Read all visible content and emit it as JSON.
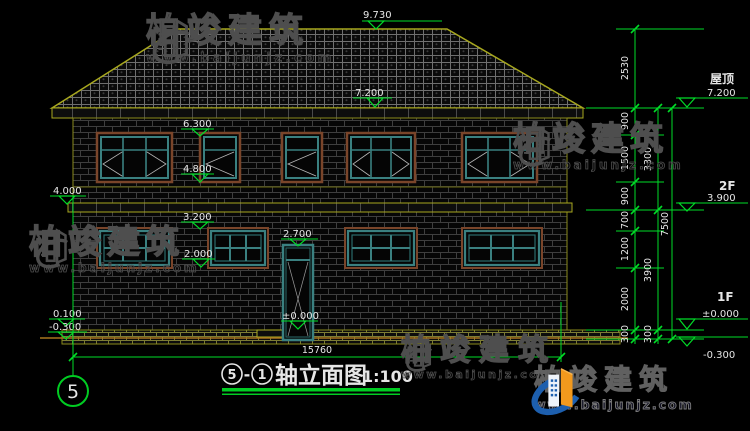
{
  "watermark": {
    "brand": "柏竣建筑",
    "url": "www.baijunjz.com"
  },
  "levels": {
    "ridge": "9.730",
    "eave": "7.200",
    "f2_win_top": "6.300",
    "f2_win_btm": "4.800",
    "belt": "4.000",
    "f1_win_top": "3.200",
    "f1_win_btm": "2.000",
    "door_top": "2.700",
    "door_floor": "±0.000",
    "plinth": "0.100",
    "ground": "-0.300"
  },
  "floors": {
    "roof_name": "屋顶",
    "roof_lvl": "7.200",
    "f2_name": "2F",
    "f2_lvl": "3.900",
    "f1_name": "1F",
    "f1_lvl": "±0.000",
    "ground_lvl": "-0.300"
  },
  "dims": {
    "c1": [
      "2530",
      "900",
      "1500",
      "900",
      "700",
      "1200",
      "2000",
      "300"
    ],
    "c2": [
      "3300",
      "3900",
      "300"
    ],
    "c3": [
      "7500"
    ],
    "total": "15760"
  },
  "title": {
    "bubble_left": "5",
    "sep": "-",
    "bubble_right": "1",
    "text": "轴立面图",
    "scale": "1:100"
  },
  "axis": {
    "bubble": "5"
  }
}
